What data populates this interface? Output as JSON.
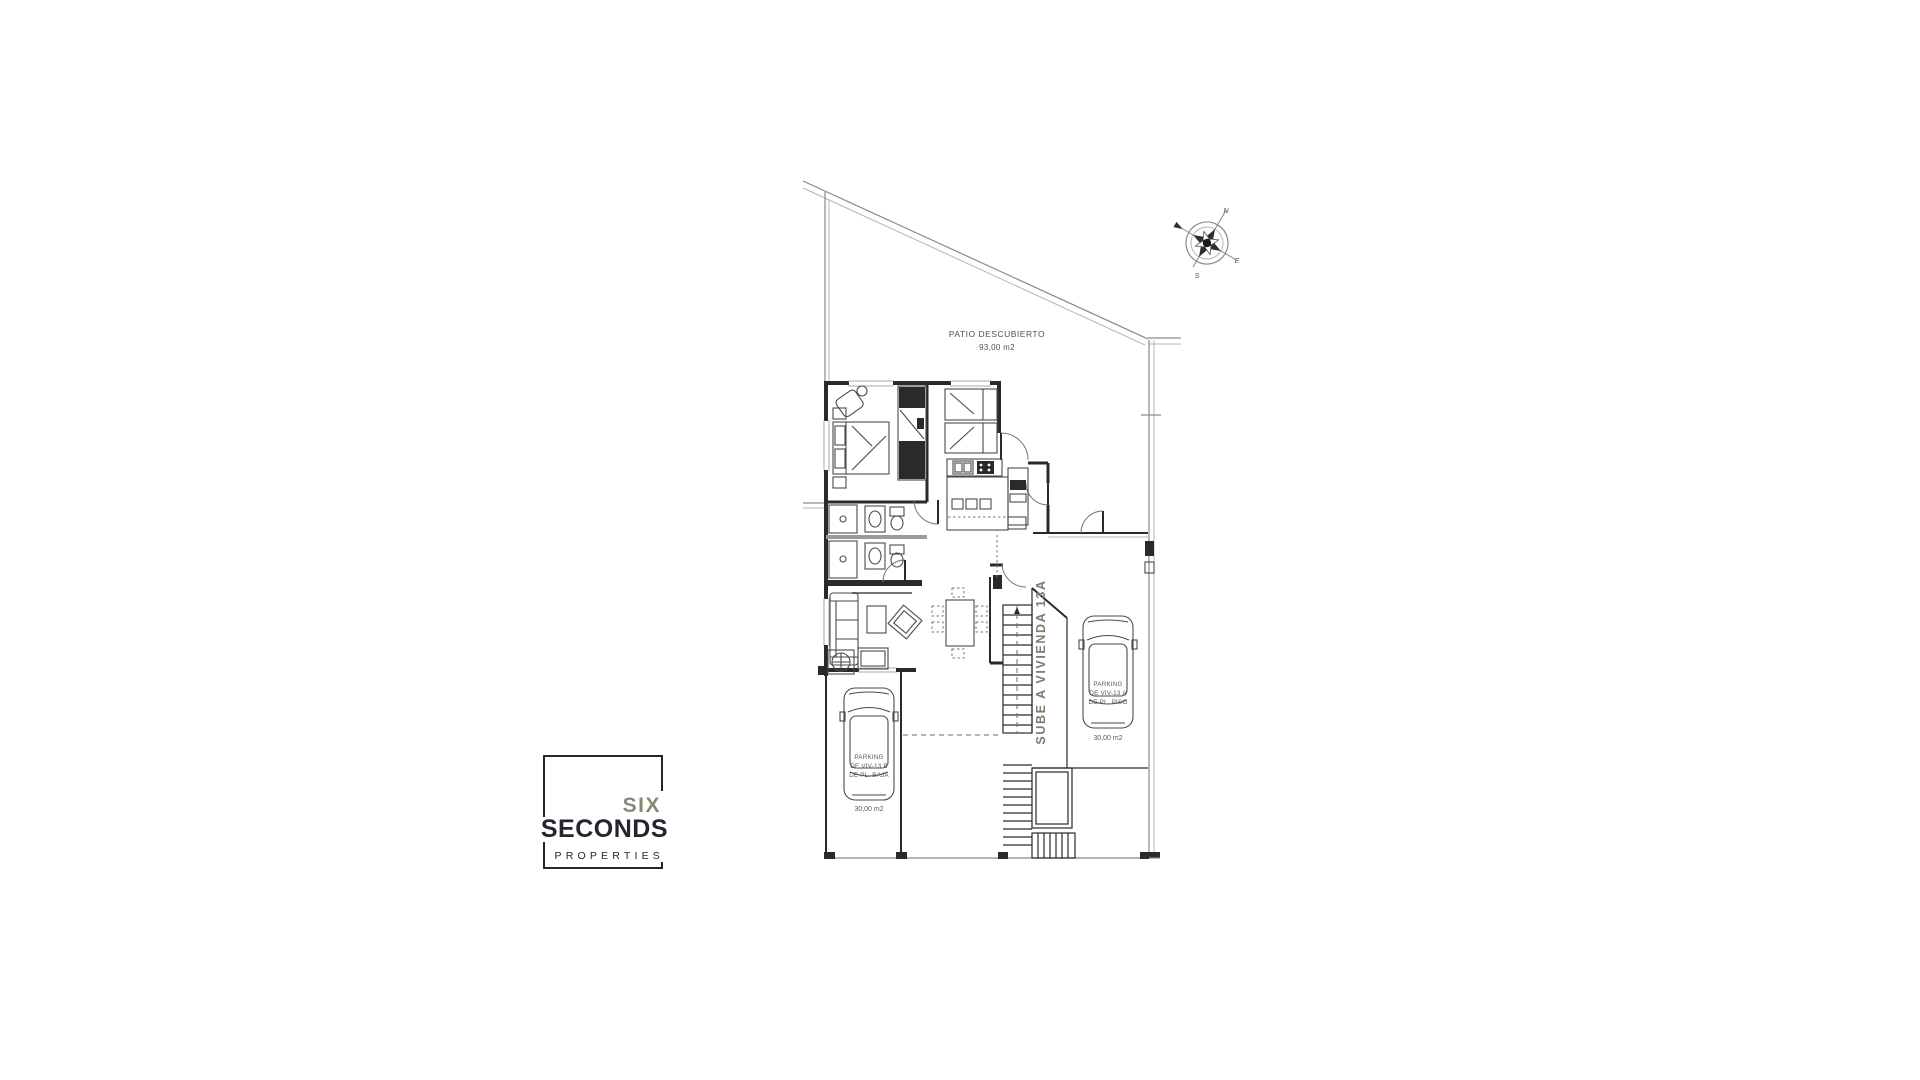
{
  "colors": {
    "wall": "#2a2a2a",
    "line": "#8a8a8a",
    "light": "#b5b5b5",
    "furn": "#4a4a4a",
    "label": "#4f4f4f",
    "stairs-label": "#75806b",
    "logo-six": "#8c8973",
    "logo-dark": "#23252f",
    "compass-letter": "#4a5264"
  },
  "plan": {
    "patio_label": "PATIO DESCUBIERTO",
    "patio_area": "93,00 m2",
    "stairs_label": "SUBE A VIVIENDA 13A",
    "parking_left": {
      "l1": "PARKING",
      "l2": "DE VIV-13 B",
      "l3": "DE PL. BAJA",
      "area": "30,00 m2"
    },
    "parking_right": {
      "l1": "PARKING",
      "l2": "DE VIV-13 A",
      "l3": "DE PL. PISO",
      "area": "30,00 m2"
    },
    "compass": {
      "n": "N",
      "e": "E",
      "s": "S"
    }
  },
  "logo": {
    "top": "SIX",
    "middle": "SECONDS",
    "bottom": "PROPERTIES"
  }
}
